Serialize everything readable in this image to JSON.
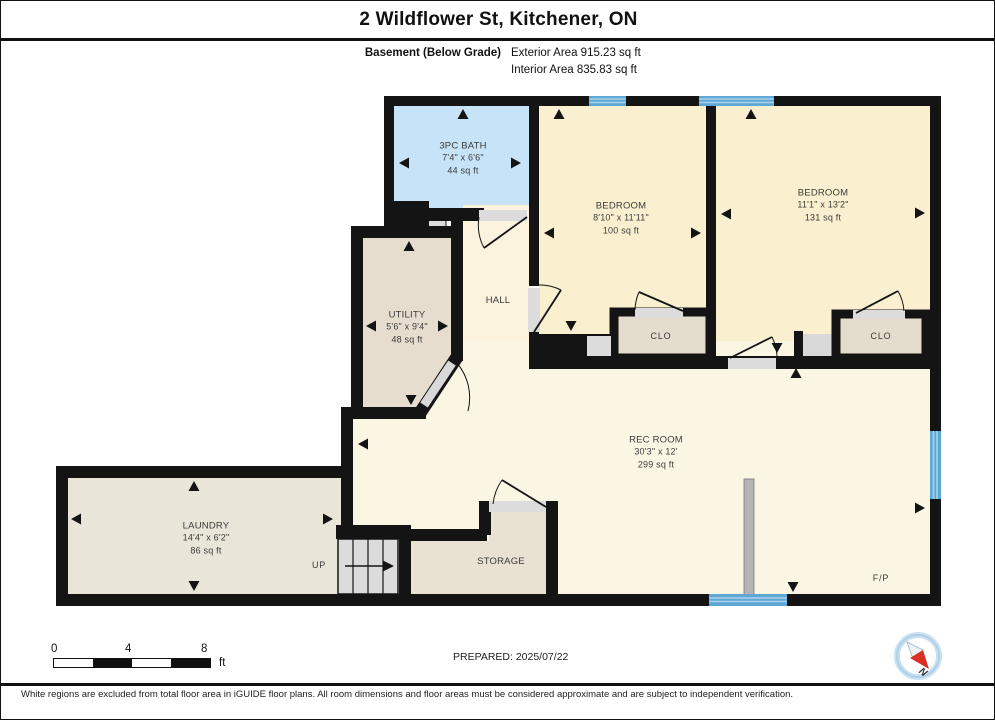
{
  "header": {
    "title": "2 Wildflower St, Kitchener, ON",
    "floor_label": "Basement (Below Grade)",
    "exterior_area": "Exterior Area 915.23 sq ft",
    "interior_area": "Interior Area 835.83 sq ft"
  },
  "rooms": [
    {
      "id": "bath",
      "name": "3PC BATH",
      "dims": "7'4\" x 6'6\"",
      "area": "44 sq ft"
    },
    {
      "id": "bedroom1",
      "name": "BEDROOM",
      "dims": "8'10\" x 11'11\"",
      "area": "100 sq ft"
    },
    {
      "id": "bedroom2",
      "name": "BEDROOM",
      "dims": "11'1\" x 13'2\"",
      "area": "131 sq ft"
    },
    {
      "id": "utility",
      "name": "UTILITY",
      "dims": "5'6\" x 9'4\"",
      "area": "48 sq ft"
    },
    {
      "id": "hall",
      "name": "HALL"
    },
    {
      "id": "recroom",
      "name": "REC ROOM",
      "dims": "30'3\" x 12'",
      "area": "299 sq ft"
    },
    {
      "id": "laundry",
      "name": "LAUNDRY",
      "dims": "14'4\" x 6'2\"",
      "area": "86 sq ft"
    },
    {
      "id": "storage",
      "name": "STORAGE"
    },
    {
      "id": "closet1",
      "name": "CLO"
    },
    {
      "id": "closet2",
      "name": "CLO"
    },
    {
      "id": "fireplace",
      "name": "F/P"
    },
    {
      "id": "stairs",
      "name": "UP"
    }
  ],
  "scale_bar": {
    "start": "0",
    "mid": "4",
    "end": "8",
    "unit": "ft"
  },
  "prepared": "PREPARED: 2025/07/22",
  "compass": {
    "label": "N"
  },
  "footer": "White regions are excluded from total floor area in iGUIDE floor plans. All room dimensions and floor areas must be considered approximate and are subject to independent verification.",
  "colors": {
    "wall": "#141414",
    "bath_fill": "#c6e3f7",
    "bedroom_fill": "#faefcf",
    "rec_fill": "#fbf6e4",
    "service_fill": "#e6ddce",
    "window_blue": "#5fa8d5",
    "door_grey": "#dcdcdc",
    "compass_red": "#d93025",
    "compass_ring": "#aecfe6"
  }
}
